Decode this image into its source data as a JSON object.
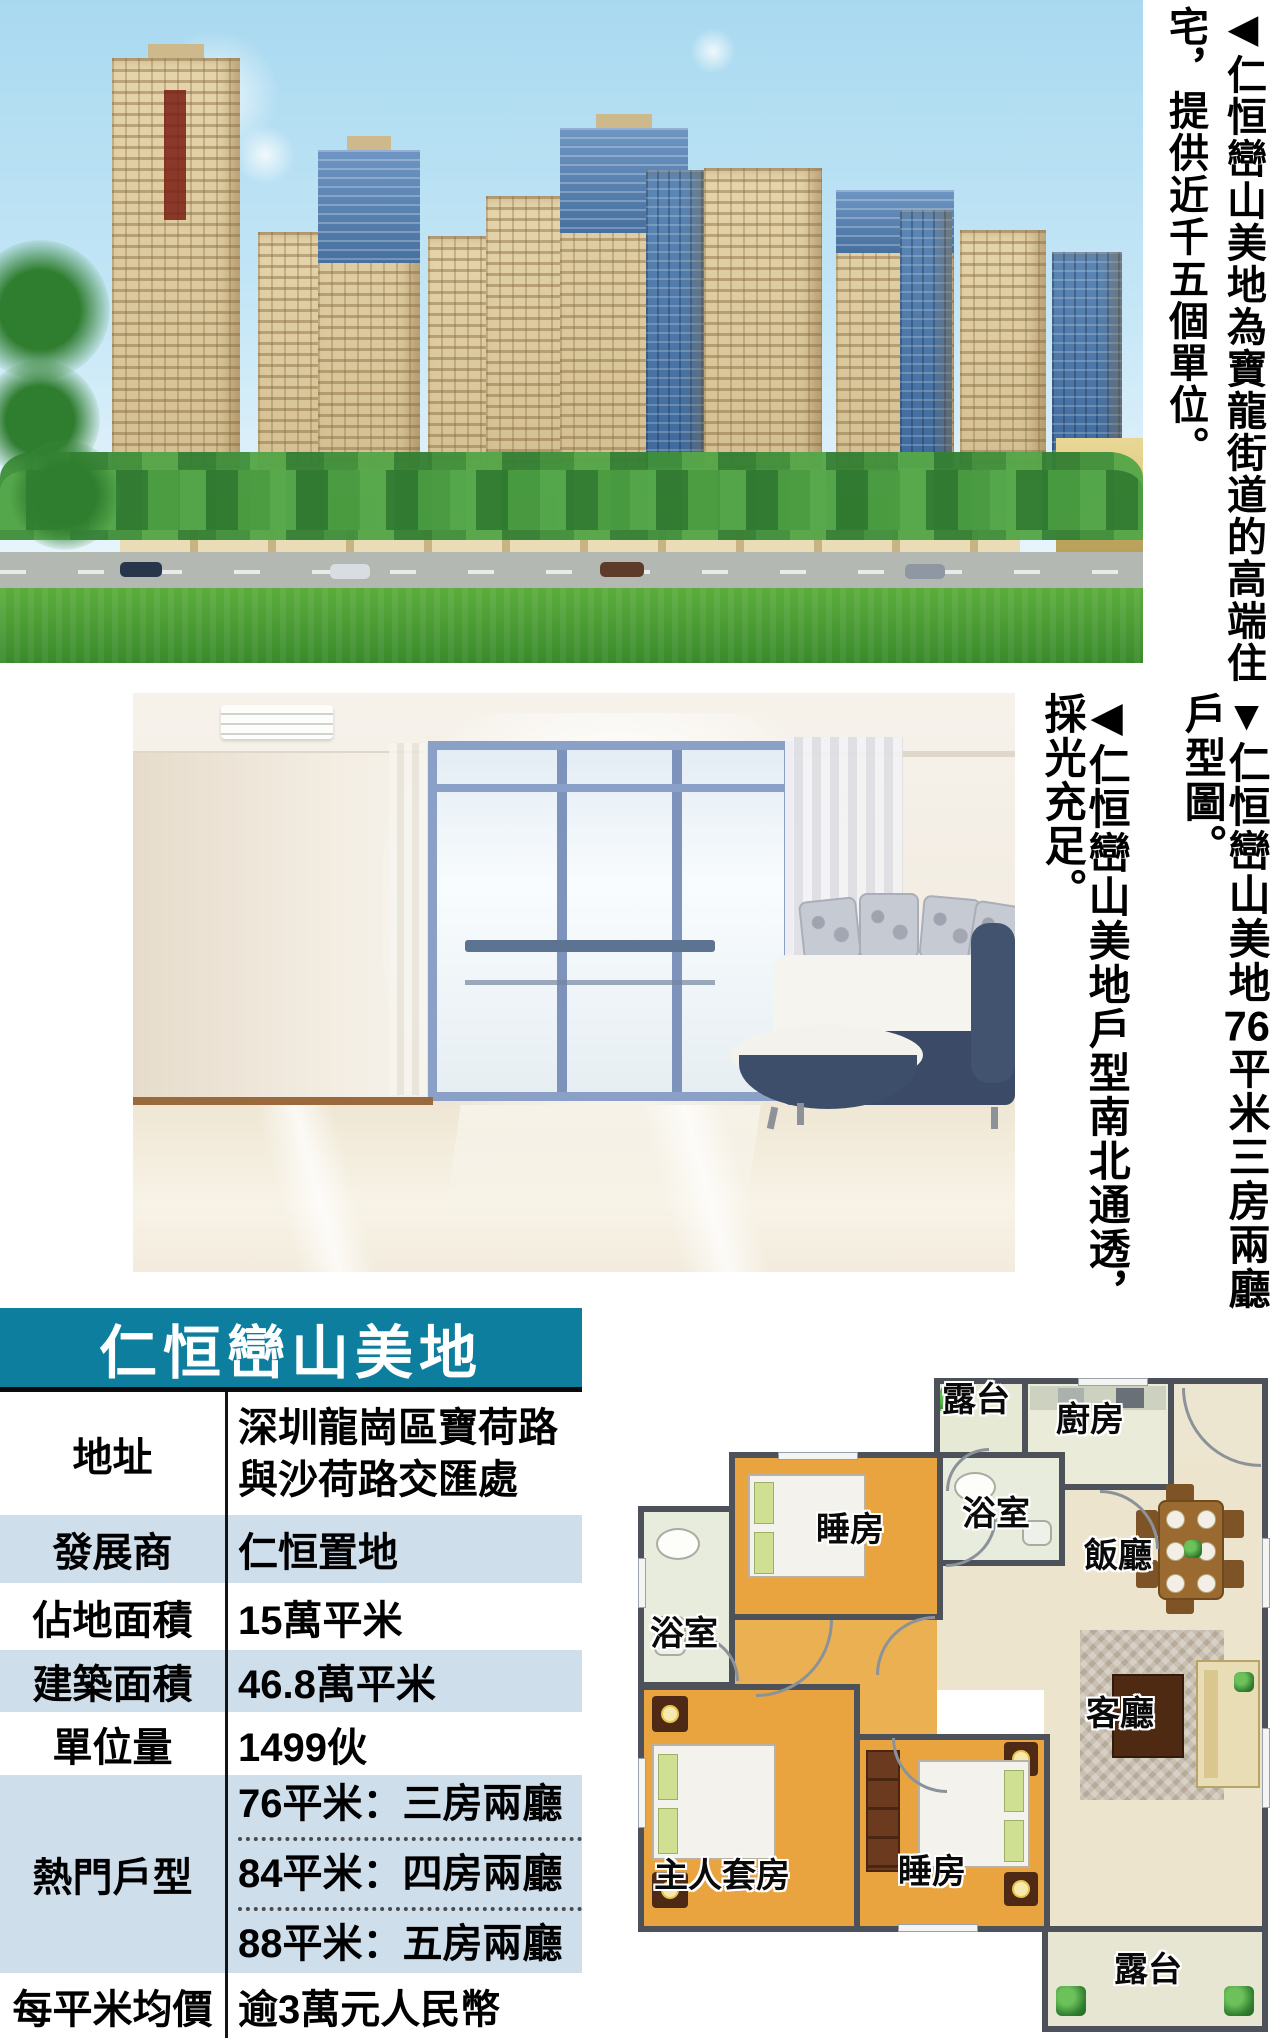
{
  "palette": {
    "header_teal": "#0e7e9e",
    "row_alt_blue": "#cfdeeb",
    "plan_wall_gray": "#4d525a",
    "plan_floor_orange": "#e9a43f",
    "plan_floor_beige": "#ece4cd",
    "plan_floor_green": "#e8ecdc"
  },
  "captions": {
    "top_photo": {
      "line1": "◀仁恒巒山美地為寶龍街道的高端住",
      "line2": "宅，提供近千五個單位。"
    },
    "floor_plan": {
      "line1_prefix": "▼仁恒巒山美地",
      "line1_number": "76",
      "line1_suffix": "平米三房兩廳",
      "line2": "戶型圖。"
    },
    "living_photo": {
      "line1": "◀仁恒巒山美地戶型南北通透，",
      "line2": "採光充足。"
    }
  },
  "info_table": {
    "title": "仁恒巒山美地",
    "rows": [
      {
        "label": "地址",
        "value_line1": "深圳龍崗區寶荷路",
        "value_line2": "與沙荷路交匯處"
      },
      {
        "label": "發展商",
        "value": "仁恒置地"
      },
      {
        "label": "佔地面積",
        "value": "15萬平米"
      },
      {
        "label": "建築面積",
        "value": "46.8萬平米"
      },
      {
        "label": "單位量",
        "value": "1499伙"
      },
      {
        "label": "熱門戶型",
        "values": [
          "76平米：三房兩廳",
          "84平米：四房兩廳",
          "88平米：五房兩廳"
        ]
      },
      {
        "label": "每平米均價",
        "value": "逾3萬元人民幣"
      }
    ]
  },
  "floor_plan": {
    "rooms": {
      "balcony_top": "露台",
      "kitchen": "廚房",
      "bedroom_top": "睡房",
      "bathroom_right": "浴室",
      "bathroom_left": "浴室",
      "dining": "飯廳",
      "living": "客廳",
      "master_bedroom": "主人套房",
      "bedroom_second": "睡房",
      "balcony_bottom": "露台"
    }
  }
}
